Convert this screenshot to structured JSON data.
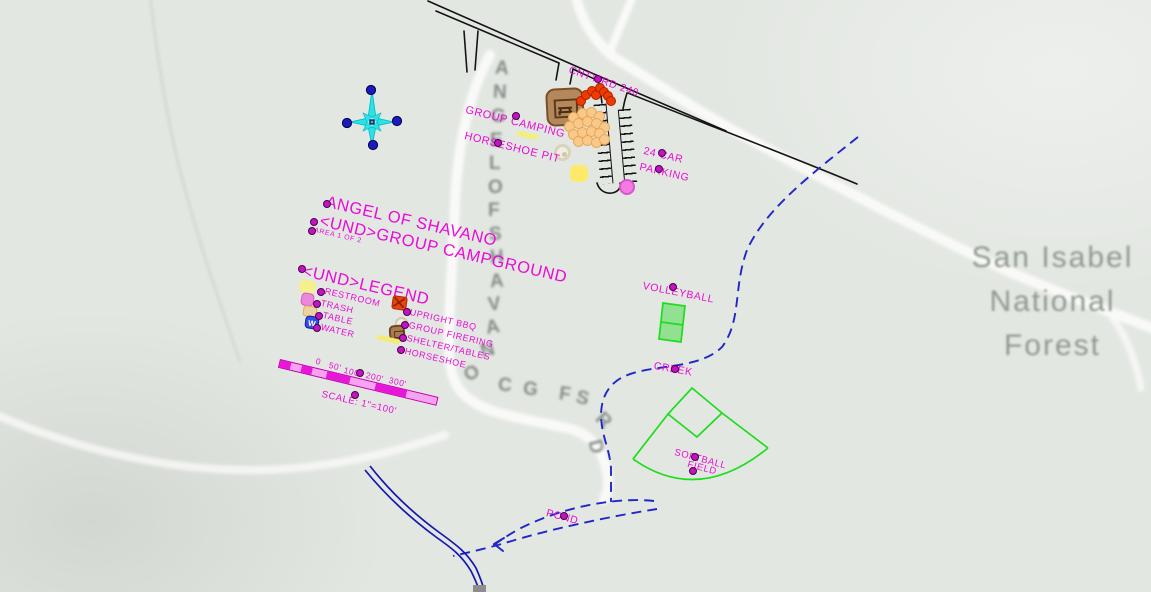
{
  "colors": {
    "magenta_text": "#ea0bd8",
    "road_black": "#141414",
    "creek_blue": "#2026c8",
    "stream_blue": "#1616b0",
    "field_green": "#1edc1e",
    "compass_cyan": "#2ce2e2",
    "raster_gray": "#8f998f",
    "scalebar_magenta": "#e816d8"
  },
  "forest": {
    "line1": "San Isabel",
    "line2": "National",
    "line3": "Forest"
  },
  "road_name": {
    "text": "ANGEL OF SHAVANO CG FS RD",
    "letters": [
      {
        "c": "A",
        "x": 495,
        "y": 58,
        "r": 4
      },
      {
        "c": "N",
        "x": 493,
        "y": 82,
        "r": 2
      },
      {
        "c": "G",
        "x": 491,
        "y": 106,
        "r": 0
      },
      {
        "c": "E",
        "x": 490,
        "y": 130,
        "r": 0
      },
      {
        "c": "L",
        "x": 489,
        "y": 153,
        "r": 0
      },
      {
        "c": "O",
        "x": 488,
        "y": 177,
        "r": 0
      },
      {
        "c": "F",
        "x": 488,
        "y": 200,
        "r": 0
      },
      {
        "c": "S",
        "x": 489,
        "y": 224,
        "r": -2
      },
      {
        "c": "H",
        "x": 490,
        "y": 247,
        "r": -3
      },
      {
        "c": "A",
        "x": 490,
        "y": 271,
        "r": -4
      },
      {
        "c": "V",
        "x": 488,
        "y": 294,
        "r": -6
      },
      {
        "c": "A",
        "x": 486,
        "y": 317,
        "r": -10
      },
      {
        "c": "N",
        "x": 481,
        "y": 340,
        "r": -16
      },
      {
        "c": "O",
        "x": 465,
        "y": 363,
        "r": -35
      },
      {
        "c": "C",
        "x": 498,
        "y": 375,
        "r": 5
      },
      {
        "c": "G",
        "x": 523,
        "y": 379,
        "r": 8
      },
      {
        "c": "F",
        "x": 559,
        "y": 384,
        "r": 8
      },
      {
        "c": "S",
        "x": 576,
        "y": 388,
        "r": 14
      },
      {
        "c": "R",
        "x": 596,
        "y": 410,
        "r": 45
      },
      {
        "c": "D",
        "x": 588,
        "y": 436,
        "r": 75
      }
    ]
  },
  "labels": {
    "cnty_rd": "CNTY RD 240",
    "group_camping": "GROUP CAMPING",
    "horseshoe_pit": "HORSESHOE PIT",
    "parking_line1": "24 CAR",
    "parking_line2": "PARKING",
    "title_line1": "ANGEL OF SHAVANO",
    "title_line2": "<UND>GROUP CAMPGROUND",
    "area": "AREA 1 OF 2",
    "volleyball": "VOLLEYBALL",
    "creek": "CREEK",
    "softball_line1": "SOFTBALL",
    "softball_line2": "FIELD",
    "pond": "POND"
  },
  "legend": {
    "title": "<UND>LEGEND",
    "left": [
      {
        "label": "RESTROOM"
      },
      {
        "label": "TRASH"
      },
      {
        "label": "TABLE"
      },
      {
        "label": "WATER"
      }
    ],
    "right": [
      {
        "label": "UPRIGHT BBQ"
      },
      {
        "label": "GROUP FIRERING"
      },
      {
        "label": "SHELTER/TABLES"
      },
      {
        "label": "HORSESHOE"
      }
    ],
    "water_icon_letter": "W"
  },
  "scale": {
    "ticks": [
      "0",
      "50'",
      "100'",
      "200'",
      "300'"
    ],
    "caption": "SCALE: 1\"=100'"
  },
  "nodes": [
    [
      327,
      204
    ],
    [
      314,
      222
    ],
    [
      312,
      231
    ],
    [
      302,
      269
    ],
    [
      321,
      292
    ],
    [
      317,
      304
    ],
    [
      319,
      316
    ],
    [
      317,
      328
    ],
    [
      407,
      312
    ],
    [
      405,
      325
    ],
    [
      403,
      338
    ],
    [
      401,
      350
    ],
    [
      360,
      373
    ],
    [
      355,
      395
    ],
    [
      516,
      116
    ],
    [
      498,
      143
    ],
    [
      598,
      79
    ],
    [
      662,
      153
    ],
    [
      659,
      169
    ],
    [
      673,
      287
    ],
    [
      675,
      369
    ],
    [
      695,
      457
    ],
    [
      693,
      471
    ],
    [
      564,
      516
    ]
  ],
  "bbq_dots": [
    [
      580,
      100
    ],
    [
      585,
      94
    ],
    [
      591,
      90
    ],
    [
      595,
      94
    ],
    [
      599,
      87
    ],
    [
      603,
      91
    ],
    [
      607,
      95
    ],
    [
      610,
      100
    ]
  ],
  "table_dots": [
    [
      573,
      117
    ],
    [
      582,
      113
    ],
    [
      591,
      112
    ],
    [
      599,
      116
    ],
    [
      569,
      126
    ],
    [
      578,
      123
    ],
    [
      587,
      121
    ],
    [
      596,
      123
    ],
    [
      604,
      127
    ],
    [
      573,
      134
    ],
    [
      582,
      132
    ],
    [
      591,
      131
    ],
    [
      599,
      133
    ],
    [
      578,
      141
    ],
    [
      587,
      140
    ],
    [
      596,
      142
    ],
    [
      604,
      139
    ]
  ]
}
